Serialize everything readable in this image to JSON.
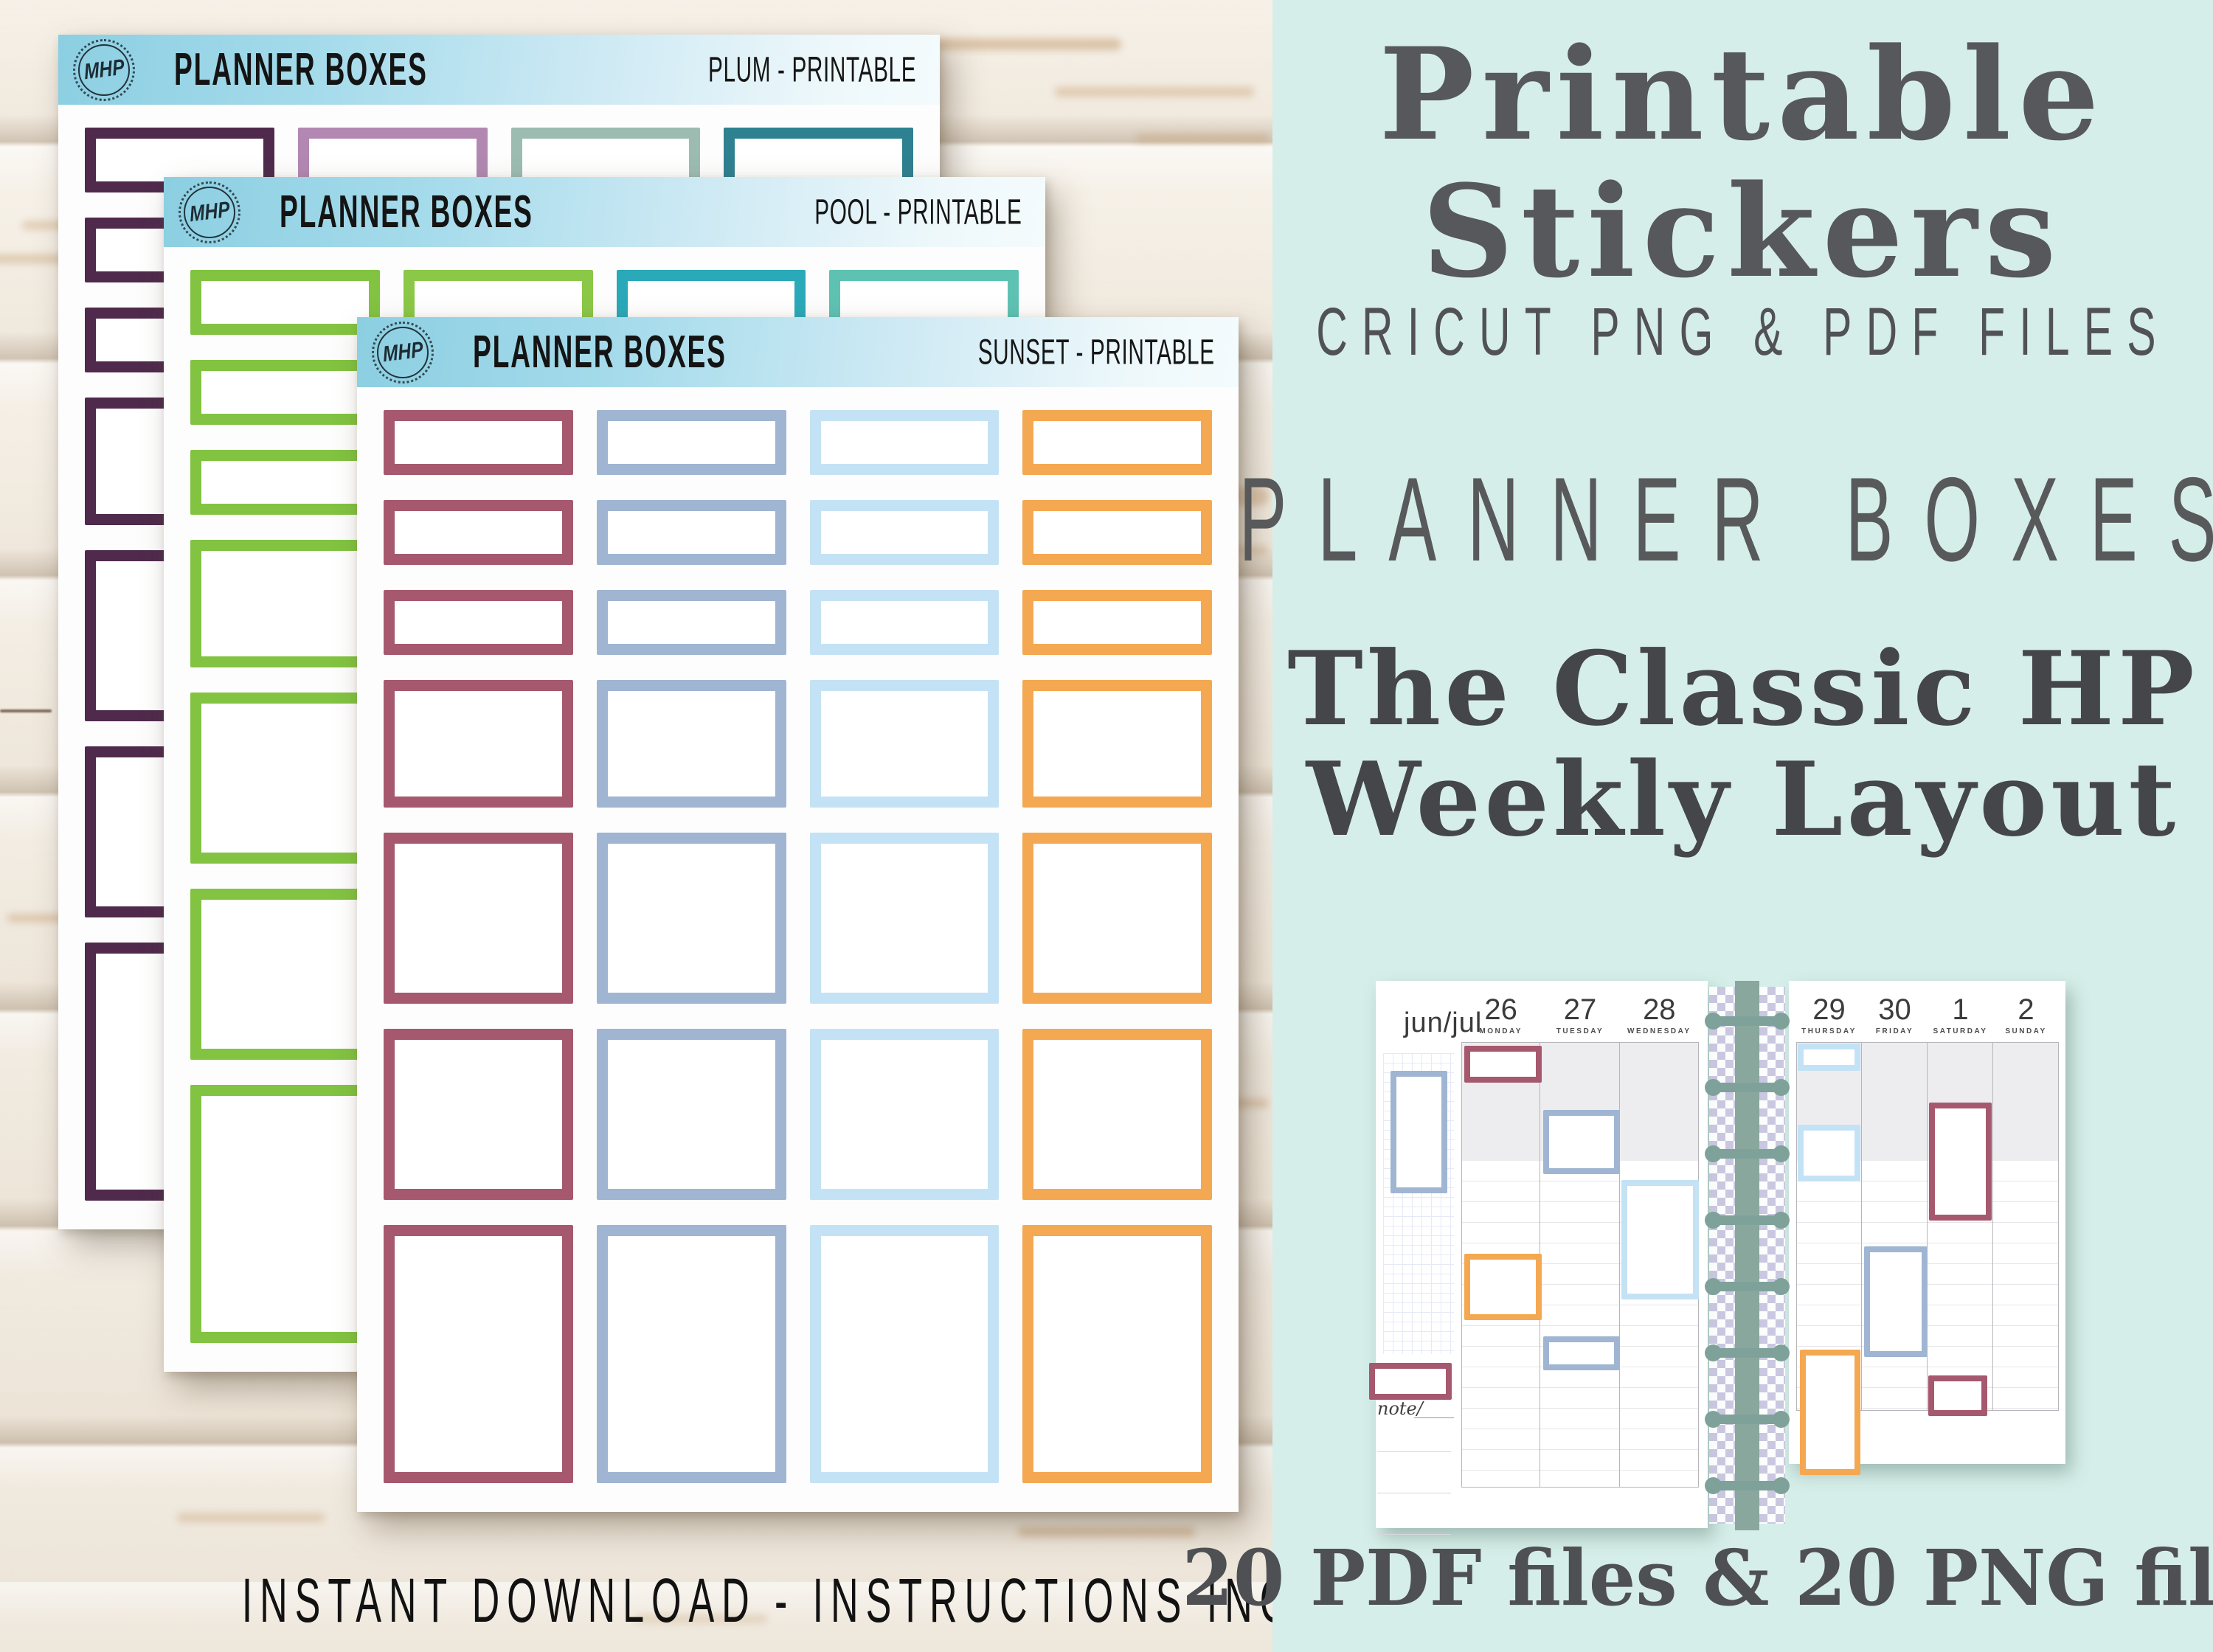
{
  "left_caption": "INSTANT DOWNLOAD - INSTRUCTIONS INCLUDED",
  "sheet_rows": [
    "half",
    "half",
    "half",
    "med",
    "sq",
    "sq",
    "tall"
  ],
  "sheets": [
    {
      "name": "plum",
      "logo": "MHP",
      "title": "PLANNER BOXES",
      "subtitle": "PLUM - PRINTABLE",
      "colors": [
        "#4f2a4c",
        "#b288b2",
        "#9cbcb2",
        "#2e8191"
      ]
    },
    {
      "name": "pool",
      "logo": "MHP",
      "title": "PLANNER BOXES",
      "subtitle": "POOL - PRINTABLE",
      "colors": [
        "#82c341",
        "#8bc847",
        "#2aa9b9",
        "#5ec2b3"
      ]
    },
    {
      "name": "sunset",
      "logo": "MHP",
      "title": "PLANNER BOXES",
      "subtitle": "SUNSET - PRINTABLE",
      "colors": [
        "#a6596e",
        "#9fb5d2",
        "#c4e2f5",
        "#f4a851"
      ]
    }
  ],
  "right_panel": {
    "title_line1": "Printable",
    "title_line2": "Stickers",
    "subtitle": "CRICUT PNG & PDF FILES",
    "product_name": "PLANNER BOXES",
    "tagline_line1": "The Classic HP",
    "tagline_line2": "Weekly Layout",
    "footer": "20 PDF files & 20 PNG files",
    "planner": {
      "month_label": "jun/jul",
      "note_label": "note/",
      "left_days": [
        {
          "num": "26",
          "name": "MONDAY"
        },
        {
          "num": "27",
          "name": "TUESDAY"
        },
        {
          "num": "28",
          "name": "WEDNESDAY"
        }
      ],
      "right_days": [
        {
          "num": "29",
          "name": "THURSDAY"
        },
        {
          "num": "30",
          "name": "FRIDAY"
        },
        {
          "num": "1",
          "name": "SATURDAY"
        },
        {
          "num": "2",
          "name": "SUNDAY"
        }
      ]
    }
  },
  "palette": {
    "rose": "#a6596e",
    "bluegray": "#9fb5d2",
    "lightblue": "#c4e2f5",
    "orange": "#f4a851",
    "mint_bg": "#d6eee9",
    "heading_gray": "#57585b",
    "header_blue": "#8ccfe2",
    "binding_green": "#8aa79e",
    "washi_lavender": "#c9c4e0"
  }
}
